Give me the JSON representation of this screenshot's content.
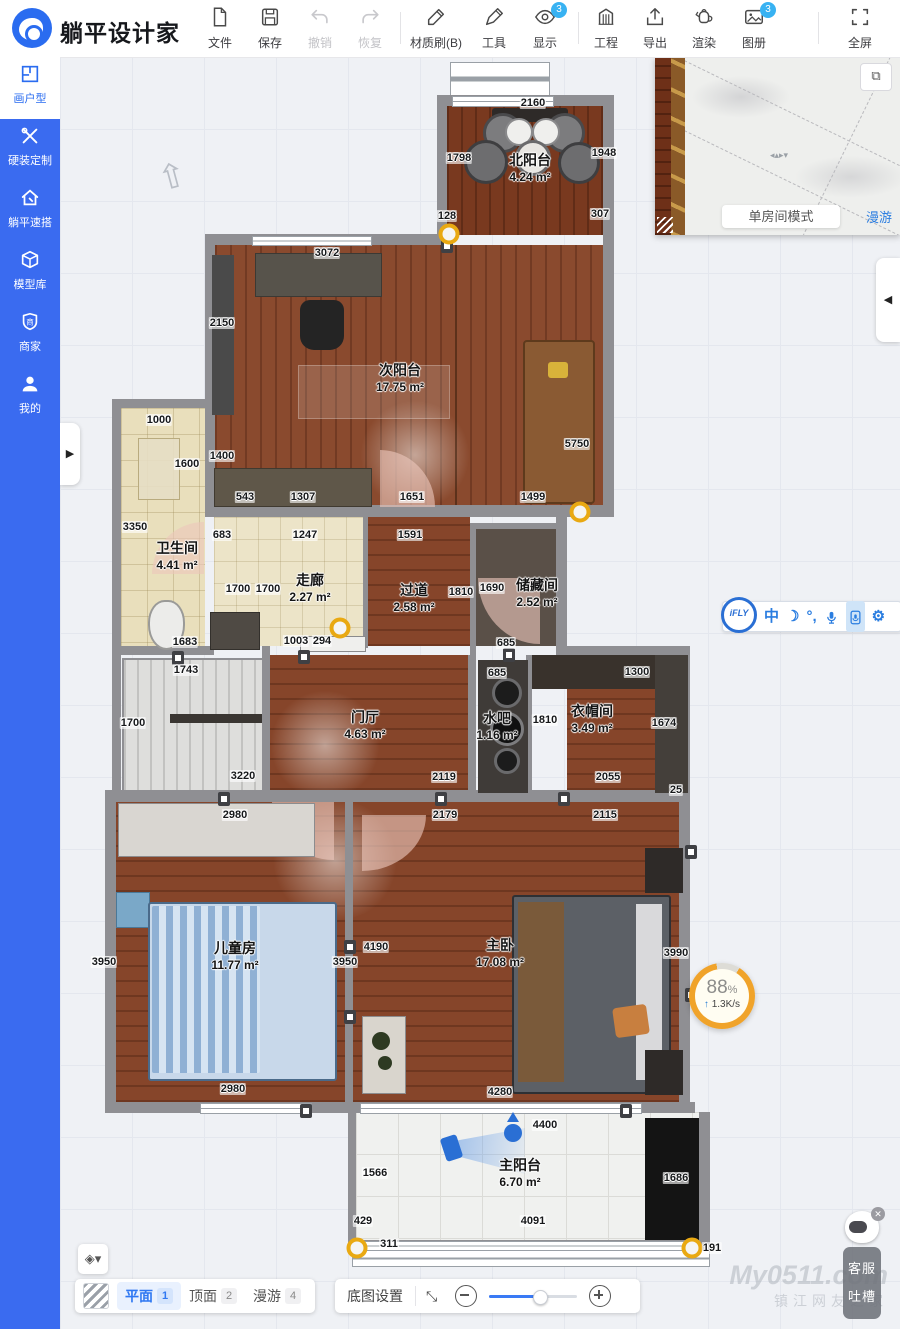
{
  "app": {
    "name": "躺平设计家"
  },
  "toolbar": {
    "items": [
      {
        "label": "文件"
      },
      {
        "label": "保存"
      },
      {
        "label": "撤销"
      },
      {
        "label": "恢复"
      },
      {
        "label": "材质刷(B)"
      },
      {
        "label": "工具"
      },
      {
        "label": "显示",
        "badge": "3"
      },
      {
        "label": "工程"
      },
      {
        "label": "导出"
      },
      {
        "label": "渲染"
      },
      {
        "label": "图册",
        "badge": "3"
      },
      {
        "label": "全屏"
      }
    ]
  },
  "sidebar": {
    "items": [
      {
        "label": "画户型",
        "active": true
      },
      {
        "label": "硬装定制",
        "active": false
      },
      {
        "label": "躺平速搭",
        "active": false
      },
      {
        "label": "模型库",
        "active": false
      },
      {
        "label": "商家",
        "active": false
      },
      {
        "label": "我的",
        "active": false
      }
    ]
  },
  "preview": {
    "mode_button": "单房间模式",
    "roam_link": "漫游"
  },
  "ifly": {
    "logo": "iFLY",
    "lang": "中",
    "punct": "°,"
  },
  "progress": {
    "percent": "88",
    "percent_sign": "%",
    "arrow": "↑",
    "speed": "1.3K/s"
  },
  "plan": {
    "rooms": [
      {
        "name": "北阳台",
        "area": "4.24 m²",
        "x": 530,
        "y": 150
      },
      {
        "name": "次阳台",
        "area": "17.75 m²",
        "x": 400,
        "y": 360
      },
      {
        "name": "卫生间",
        "area": "4.41 m²",
        "x": 177,
        "y": 538
      },
      {
        "name": "走廊",
        "area": "2.27 m²",
        "x": 310,
        "y": 570
      },
      {
        "name": "过道",
        "area": "2.58 m²",
        "x": 414,
        "y": 580
      },
      {
        "name": "储藏间",
        "area": "2.52 m²",
        "x": 537,
        "y": 575
      },
      {
        "name": "门厅",
        "area": "4.63 m²",
        "x": 365,
        "y": 707
      },
      {
        "name": "水吧",
        "area": "1.16 m²",
        "x": 497,
        "y": 708
      },
      {
        "name": "衣帽间",
        "area": "3.49 m²",
        "x": 592,
        "y": 701
      },
      {
        "name": "儿童房",
        "area": "11.77 m²",
        "x": 235,
        "y": 938
      },
      {
        "name": "主卧",
        "area": "17.08 m²",
        "x": 500,
        "y": 935
      },
      {
        "name": "主阳台",
        "area": "6.70 m²",
        "x": 520,
        "y": 1155
      }
    ],
    "dims": [
      {
        "v": "2160",
        "x": 533,
        "y": 103
      },
      {
        "v": "1798",
        "x": 459,
        "y": 158
      },
      {
        "v": "1948",
        "x": 604,
        "y": 153
      },
      {
        "v": "128",
        "x": 447,
        "y": 216
      },
      {
        "v": "307",
        "x": 600,
        "y": 214
      },
      {
        "v": "3072",
        "x": 327,
        "y": 253
      },
      {
        "v": "2150",
        "x": 222,
        "y": 323
      },
      {
        "v": "1400",
        "x": 222,
        "y": 456
      },
      {
        "v": "1000",
        "x": 159,
        "y": 420
      },
      {
        "v": "1600",
        "x": 187,
        "y": 464
      },
      {
        "v": "543",
        "x": 245,
        "y": 497
      },
      {
        "v": "1307",
        "x": 303,
        "y": 497
      },
      {
        "v": "1651",
        "x": 412,
        "y": 497
      },
      {
        "v": "1499",
        "x": 533,
        "y": 497
      },
      {
        "v": "5750",
        "x": 577,
        "y": 444
      },
      {
        "v": "3350",
        "x": 135,
        "y": 527
      },
      {
        "v": "683",
        "x": 222,
        "y": 535
      },
      {
        "v": "1247",
        "x": 305,
        "y": 535
      },
      {
        "v": "1591",
        "x": 410,
        "y": 535
      },
      {
        "v": "1700",
        "x": 238,
        "y": 589
      },
      {
        "v": "1700",
        "x": 268,
        "y": 589
      },
      {
        "v": "1810",
        "x": 461,
        "y": 592
      },
      {
        "v": "1690",
        "x": 492,
        "y": 588
      },
      {
        "v": "685",
        "x": 506,
        "y": 643
      },
      {
        "v": "685",
        "x": 497,
        "y": 673
      },
      {
        "v": "1300",
        "x": 637,
        "y": 672
      },
      {
        "v": "1683",
        "x": 185,
        "y": 642
      },
      {
        "v": "1003",
        "x": 296,
        "y": 641
      },
      {
        "v": "294",
        "x": 322,
        "y": 641
      },
      {
        "v": "1743",
        "x": 186,
        "y": 670
      },
      {
        "v": "1700",
        "x": 133,
        "y": 723
      },
      {
        "v": "3220",
        "x": 243,
        "y": 776
      },
      {
        "v": "2119",
        "x": 444,
        "y": 777
      },
      {
        "v": "1810",
        "x": 545,
        "y": 720
      },
      {
        "v": "1674",
        "x": 664,
        "y": 723
      },
      {
        "v": "2055",
        "x": 608,
        "y": 777
      },
      {
        "v": "25",
        "x": 676,
        "y": 790
      },
      {
        "v": "2980",
        "x": 235,
        "y": 815
      },
      {
        "v": "2179",
        "x": 445,
        "y": 815
      },
      {
        "v": "2115",
        "x": 605,
        "y": 815
      },
      {
        "v": "3950",
        "x": 104,
        "y": 962
      },
      {
        "v": "3950",
        "x": 345,
        "y": 962
      },
      {
        "v": "4190",
        "x": 376,
        "y": 947
      },
      {
        "v": "3990",
        "x": 676,
        "y": 953
      },
      {
        "v": "2980",
        "x": 233,
        "y": 1089
      },
      {
        "v": "4280",
        "x": 500,
        "y": 1092
      },
      {
        "v": "4400",
        "x": 545,
        "y": 1125
      },
      {
        "v": "1566",
        "x": 375,
        "y": 1173
      },
      {
        "v": "1686",
        "x": 676,
        "y": 1178
      },
      {
        "v": "429",
        "x": 363,
        "y": 1221
      },
      {
        "v": "4091",
        "x": 533,
        "y": 1221
      },
      {
        "v": "311",
        "x": 389,
        "y": 1244
      },
      {
        "v": "191",
        "x": 712,
        "y": 1248
      }
    ],
    "markers": [
      {
        "x": 449,
        "y": 234
      },
      {
        "x": 580,
        "y": 512
      },
      {
        "x": 340,
        "y": 628
      },
      {
        "x": 357,
        "y": 1248
      },
      {
        "x": 692,
        "y": 1248
      }
    ]
  },
  "bottombar": {
    "view_tabs": [
      {
        "label": "平面",
        "num": "1",
        "active": true
      },
      {
        "label": "顶面",
        "num": "2",
        "active": false
      },
      {
        "label": "漫游",
        "num": "4",
        "active": false
      }
    ],
    "basemap_button": "底图设置"
  },
  "helper": {
    "items": [
      {
        "label": "客服"
      },
      {
        "label": "吐槽"
      }
    ]
  },
  "watermark": {
    "line1": "My0511.com",
    "line2": "镇江网友之家"
  }
}
